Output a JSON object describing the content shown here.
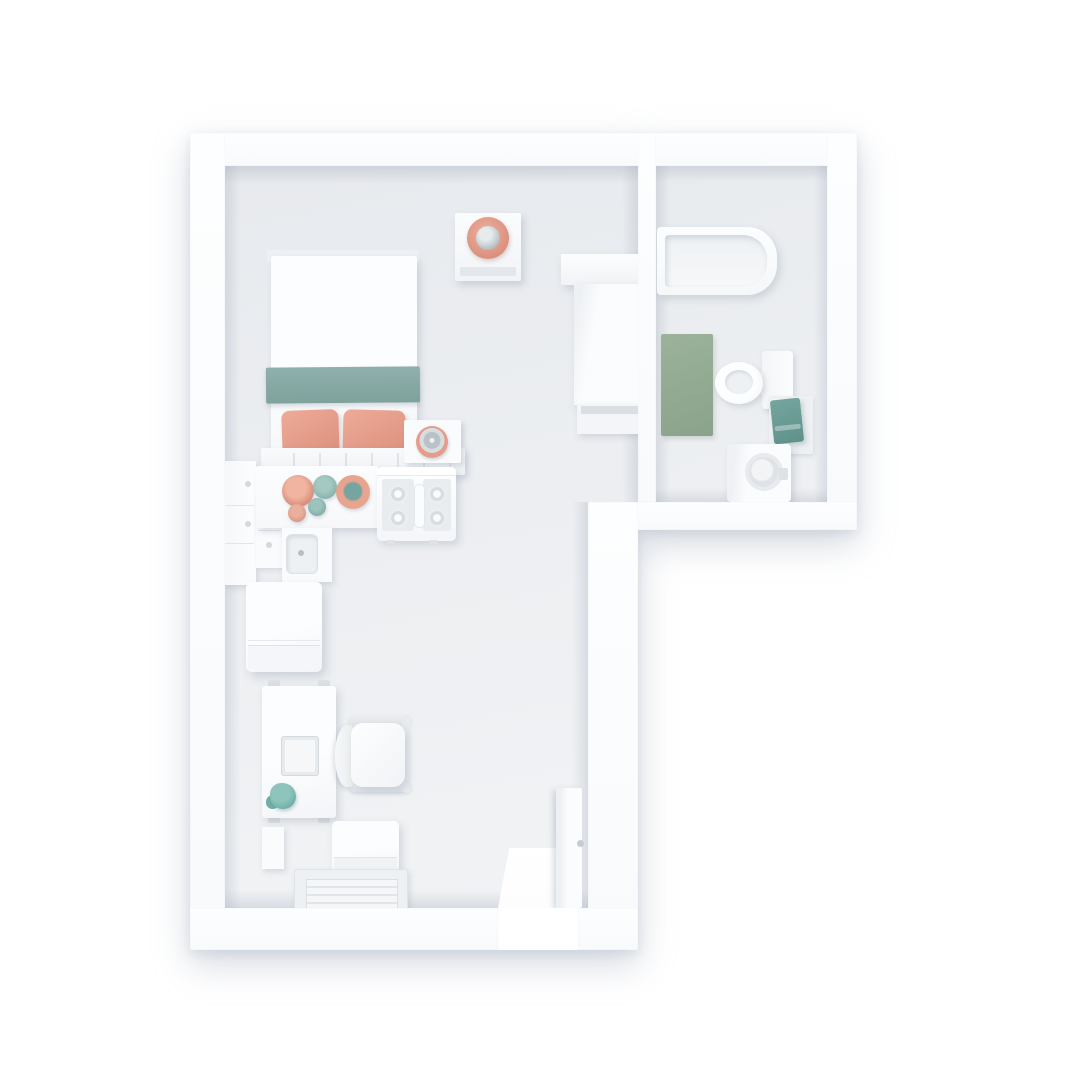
{
  "meta": {
    "scene": "3D rendered top-down floor plan of a studio apartment",
    "view": "top-down axonometric render",
    "visible_text": ""
  },
  "palette": {
    "background": "#ffffff",
    "wall": "#fbfcfe",
    "floor_dark": "#e7eaee",
    "floor_light": "#f1f3f5",
    "accent_salmon": "#e59c8a",
    "accent_salmon_deep": "#db8f7c",
    "accent_teal": "#8fb0ac",
    "accent_teal_deep": "#76a59f",
    "accent_sage": "#9cb29b",
    "metal_gray": "#97a1a7",
    "shadow": "rgba(150,162,180,0.40)"
  },
  "rooms": [
    {
      "name": "main-room",
      "furniture": [
        "double-bed-with-teal-runner-and-two-salmon-pillows",
        "headboard-shelf",
        "bedside-table-with-clock",
        "nightstand-with-salmon-lamp",
        "wardrobe-with-shelf",
        "kitchen-wall-cabinet",
        "kitchen-drawers",
        "kitchen-counter-with-bowls",
        "kitchen-sink",
        "gas-stove-four-burners",
        "fridge",
        "desk-with-laptop-and-plant",
        "office-chair",
        "ottoman",
        "ribbed-floor-mat",
        "small-wall-shelf",
        "open-entry-door"
      ]
    },
    {
      "name": "bathroom",
      "furniture": [
        "bathtub",
        "sage-bath-mat",
        "toilet",
        "teal-towel-on-rack",
        "washing-machine"
      ]
    }
  ]
}
